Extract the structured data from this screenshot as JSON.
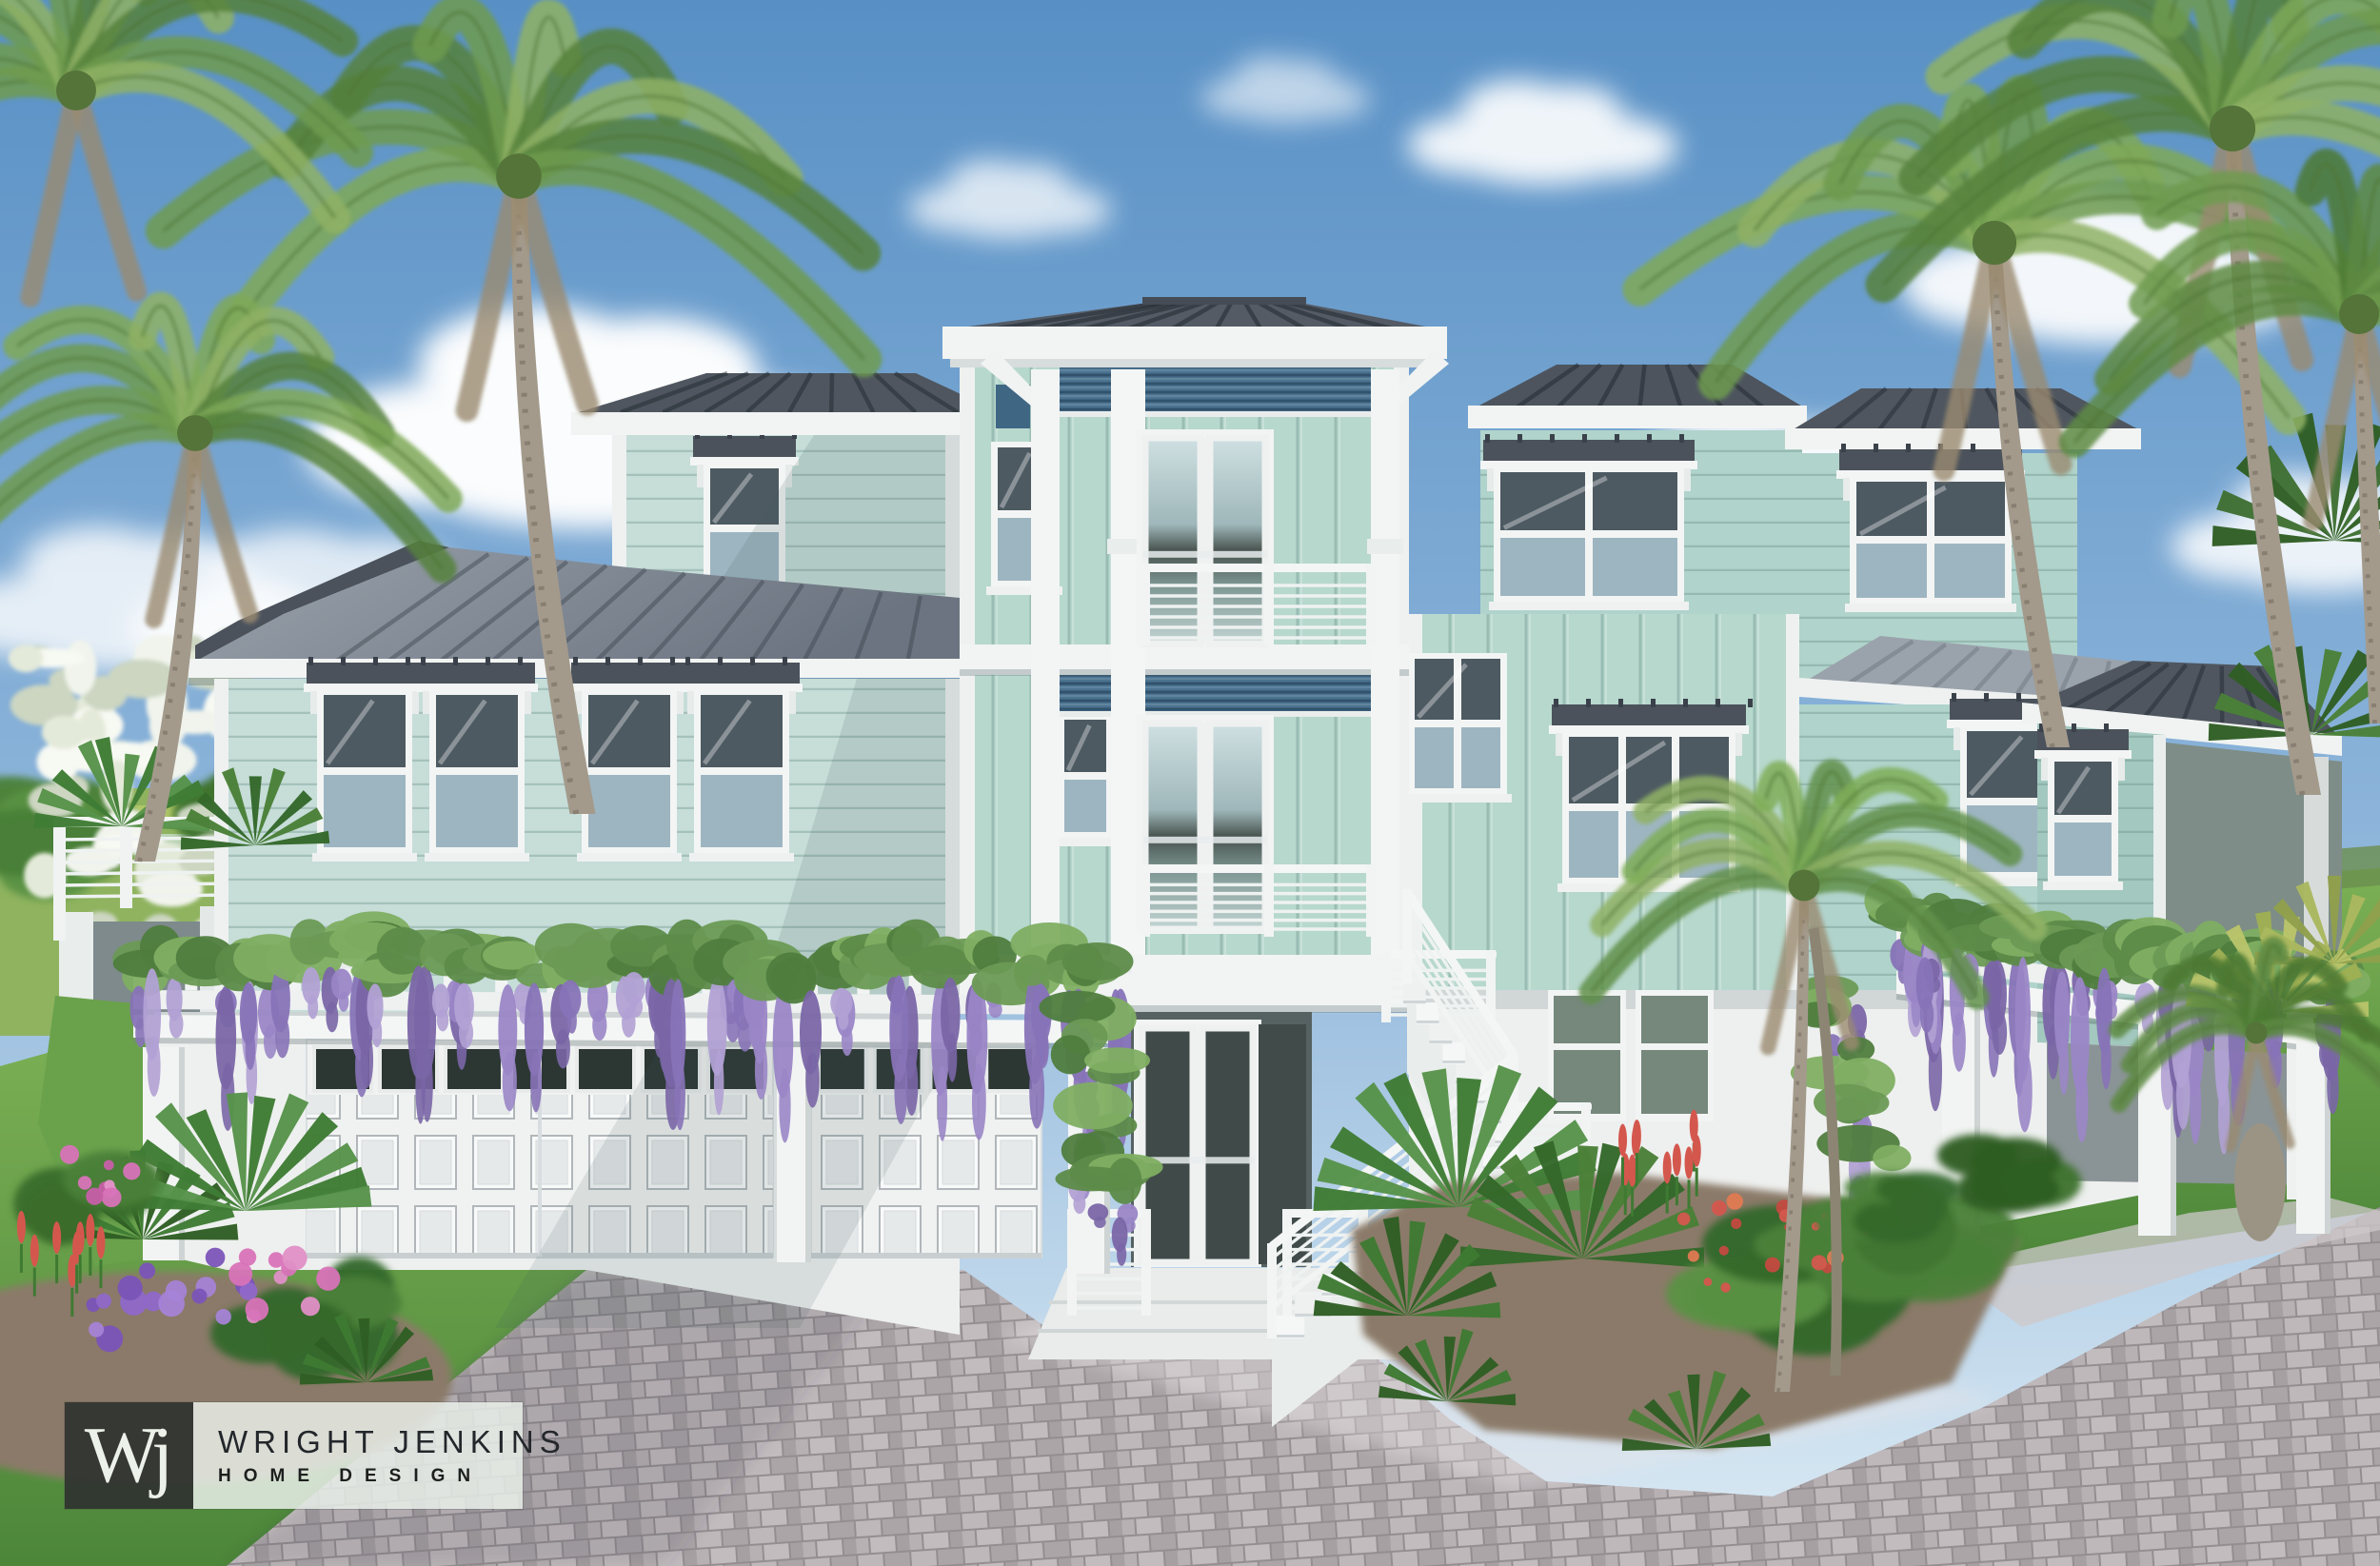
{
  "image": {
    "type": "architectural rendering",
    "subject": "Three-story coastal house exterior, front elevation",
    "style": "Key West / coastal contemporary",
    "time_of_day": "sunny day"
  },
  "branding": {
    "monogram": "Wj",
    "line1": "WRIGHT JENKINS",
    "line2": "HOME DESIGN"
  },
  "scene": {
    "elements": [
      "blue sky with cumulus clouds",
      "coconut palm trees left and right",
      "seafoam lap siding and board-and-batten siding",
      "dark standing-seam metal hip roofs",
      "blue bahama-style louver panels on central tower",
      "stacked balconies with white metal bar railings",
      "white french doors",
      "three-car garage with white paneled doors and transom lights",
      "wisteria-covered white pergolas",
      "white exterior switchback staircase",
      "gray paver driveway",
      "tropical landscaping with palmettos and flowering shrubs",
      "elevated side deck with railing"
    ]
  },
  "palette": {
    "skyTop": "#5890c5",
    "skyMid": "#8fb6db",
    "skyLow": "#dcebf4",
    "cloud": "#ffffff",
    "roofDark": "#4d545e",
    "roofMid": "#79828d",
    "roofLight": "#98a0aa",
    "trim": "#f3f5f4",
    "trimShade": "#dfe4e5",
    "wallWhite": "#eef0ef",
    "sidingLap": "#c6ddd8",
    "sidingBB": "#b7d8cd",
    "sidingRight": "#b0d3cb",
    "sidingShade": "#a3c8bf",
    "louverBlue": "#4b7390",
    "glassDark": "#4d5a62",
    "glassSky": "#9db5c1",
    "glassGreen": "#75887b",
    "lawn": "#69a24d",
    "lawnDark": "#4c8639",
    "lawnBack": "#8fb35f",
    "foliage": "#4a8038",
    "foliageDark": "#34682a",
    "palmGreen": "#6f9b4f",
    "palmLight": "#8fb265",
    "palmDark": "#4c7a33",
    "trunk": "#a39a8c",
    "wisteria": "#9a86c6",
    "wisteriaLight": "#b1a1d4",
    "wisteriaDark": "#7a66a6",
    "vineLeaf": "#6b9a55",
    "flowerPink": "#d873b8",
    "flowerPurple": "#8f68c9",
    "flowerRed": "#d4574e",
    "paver": "#b3adb0",
    "paverLight": "#c6c1c2",
    "paverJoint": "#918b8e",
    "mulch": "#8b7a69",
    "logoDark": "rgba(47,51,47,0.93)",
    "logoPanel": "rgba(233,239,233,0.85)"
  }
}
